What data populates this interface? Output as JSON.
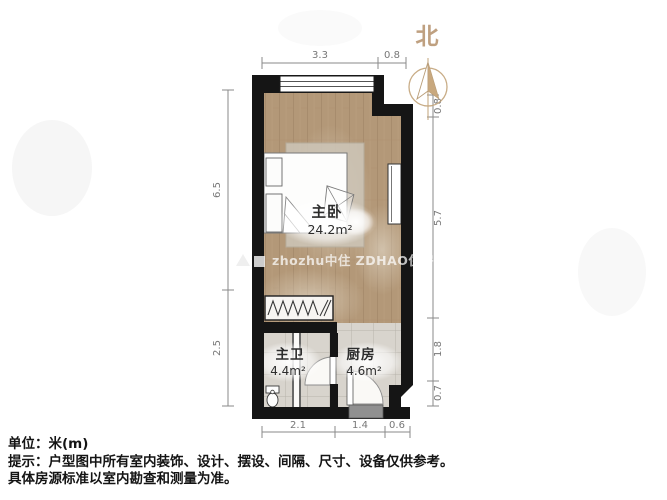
{
  "compass": {
    "label": "北"
  },
  "rooms": [
    {
      "id": "bedroom",
      "name": "主卧",
      "area": "24.2m²"
    },
    {
      "id": "bathroom",
      "name": "主卫",
      "area": "4.4m²"
    },
    {
      "id": "kitchen",
      "name": "厨房",
      "area": "4.6m²"
    }
  ],
  "dimensions": {
    "top": [
      "3.3",
      "0.8"
    ],
    "left": [
      "6.5",
      "2.5"
    ],
    "right": [
      "0.8",
      "5.7",
      "1.8",
      "0.7"
    ],
    "bottom": [
      "2.1",
      "1.4",
      "0.6"
    ]
  },
  "notes": {
    "unit": "单位：米(m)",
    "tip_line1": "提示：户型图中所有室内装饰、设计、摆设、间隔、尺寸、设备仅供参考。",
    "tip_line2": "具体房源标准以室内勘查和测量为准。"
  },
  "watermark": {
    "text": "zhozhu中住  ZDHAO住房网"
  },
  "colors": {
    "wall": "#151515",
    "wood_floor": "#b39878",
    "tile_floor": "#d8d4cd",
    "compass_tan": "#c8a87e",
    "dimension_gray": "#8a8a8a",
    "threshold_gray": "#909090"
  }
}
